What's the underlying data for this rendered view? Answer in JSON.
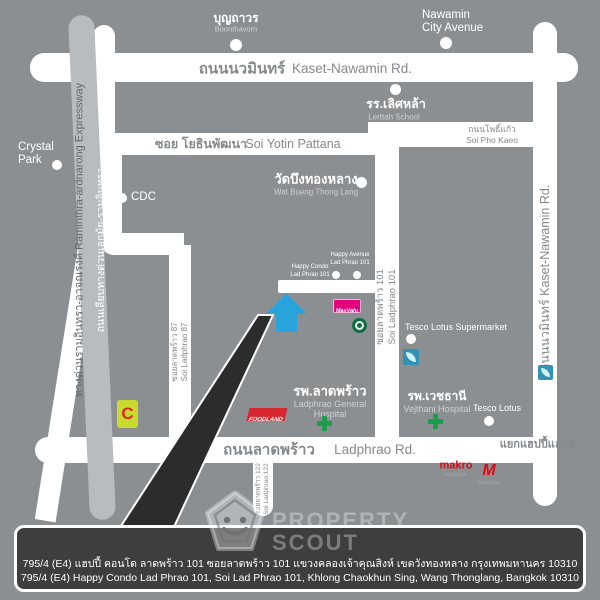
{
  "roads": {
    "kaset_h_th": "ถนนนวมินทร์",
    "kaset_h_en": "Kaset-Nawamin Rd.",
    "kaset_v": "ถนนนวมินทร์   Kaset-Nawamin Rd.",
    "yotin_th": "ซอย โยธินพัฒนา",
    "yotin_en": "Soi Yotin Pattana",
    "phokaeo_th": "ถนนโพธิ์แก้ว",
    "phokaeo_en": "Soi Pho Kaeo",
    "soi101_th": "ซอยลาดพร้าว 101",
    "soi101_en": "Soi Ladphrao 101",
    "soi87_th": "ซอยลาดพร้าว 87",
    "soi87_en": "Soi Ladphrao 87",
    "soi122_th": "ซอยลาดพร้าว 122",
    "soi122_en": "Soi Ladphrao 122",
    "ladphrao_th": "ถนนลาดพร้าว",
    "ladphrao_en": "Ladphrao Rd.",
    "happyland_junction": "แยกแฮปปี้แลนด์",
    "expressway": "ทางด่วนรามอินทรา-อาจณรงค์  Raminthra-ardnarong Expressway",
    "liab_expressway": "ถนนเลียบทางด่วนเอกมัย-รามอินทรา"
  },
  "pois": {
    "boonthavorn_th": "บุญถาวร",
    "boonthavorn_en": "Boonthavorn",
    "nawamin_line1": "Nawamin",
    "nawamin_line2": "City Avenue",
    "crystal_line1": "Crystal",
    "crystal_line2": "Park",
    "cdc": "CDC",
    "lerttah_th": "รร.เลิศหล้า",
    "lerttah_en": "Lerttah School",
    "wat_th": "วัดบึงทองหลาง",
    "wat_en": "Wat Bueng Thong Lang",
    "happy_avenue_line1": "Happy Avenue",
    "happy_avenue_line2": "Lad Phrao 101",
    "happy_condo_line1": "Happy Condo",
    "happy_condo_line2": "Lad Phrao 101",
    "tesco_supermarket": "Tesco Lotus Supermarket",
    "ladphrao_hospital_th": "รพ.ลาดพร้าว",
    "ladphrao_hospital_en1": "Ladphrao General",
    "ladphrao_hospital_en2": "Hospital",
    "vejthani_th": "รพ.เวชธานี",
    "vejthani_en": "Vejthani Hospital",
    "tesco_lotus": "Tesco Lotus",
    "makro": "makro",
    "makro_sub": "bangkapi",
    "mall_m": "M",
    "mall_sub": "bangkapi",
    "bigc_letter": "C",
    "foodland": "FOODLAND",
    "maxvalu": "MaxValu"
  },
  "watermark": {
    "line1": "PROPERTY",
    "line2": "SCOUT"
  },
  "address_bar": {
    "line_th": "795/4 (E4) แฮปปี้ คอนโด ลาดพร้าว 101  ซอยลาดพร้าว 101  แขวงคลองเจ้าคุณสิงห์ เขตวังทองหลาง กรุงเทพมหานคร 10310",
    "line_en": "795/4 (E4) Happy Condo Lad Phrao 101, Soi Lad Phrao 101, Khlong Chaokhun Sing, Wang Thonglang, Bangkok 10310"
  },
  "colors": {
    "background": "#8b8f92",
    "road": "#ffffff",
    "road_label": "#85898c",
    "expressway_band": "#b9bcbf",
    "marker_arrow": "#29a3dc",
    "hospital_cross": "#1a9e4b",
    "callout_wedge": "#2c2c2c",
    "bar_background": "#3e3e40",
    "maxvalu_pink": "#e5007d",
    "brand_red": "#e02726",
    "bigc_green": "#c9da2f",
    "starbucks_green": "#0e6b44",
    "tesco_teal": "#3193b4"
  }
}
